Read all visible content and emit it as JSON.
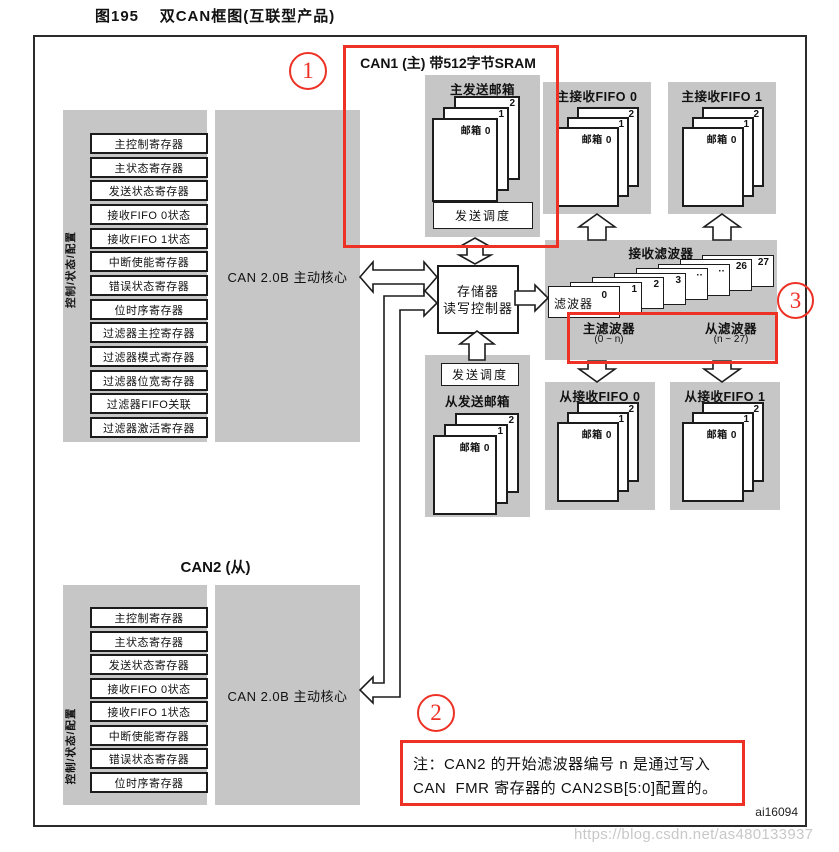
{
  "page": {
    "title": "图195    双CAN框图(互联型产品)",
    "figure_id": "ai16094",
    "watermark": "https://blog.csdn.net/as480133937"
  },
  "annotations": {
    "circle1": "1",
    "circle2": "2",
    "circle3": "3"
  },
  "can1": {
    "section_title": "CAN1 (主) 带512字节SRAM",
    "side_label": "控制/状态/配置",
    "core_label": "CAN 2.0B 主动核心",
    "registers": [
      "主控制寄存器",
      "主状态寄存器",
      "发送状态寄存器",
      "接收FIFO 0状态",
      "接收FIFO 1状态",
      "中断使能寄存器",
      "错误状态寄存器",
      "位时序寄存器",
      "过滤器主控寄存器",
      "过滤器模式寄存器",
      "过滤器位宽寄存器",
      "过滤器FIFO关联",
      "过滤器激活寄存器"
    ],
    "tx": {
      "title": "主发送邮箱",
      "mailbox_front": "邮箱 0",
      "page1": "1",
      "page2": "2",
      "scheduler": "发送调度"
    },
    "fifo0": {
      "title": "主接收FIFO 0",
      "mailbox_front": "邮箱 0",
      "page1": "1",
      "page2": "2"
    },
    "fifo1": {
      "title": "主接收FIFO 1",
      "mailbox_front": "邮箱 0",
      "page1": "1",
      "page2": "2"
    }
  },
  "memctrl": {
    "line1": "存储器",
    "line2": "读写控制器"
  },
  "filters": {
    "title": "接收滤波器",
    "front_name": "滤波器",
    "front_num": "0",
    "nums": [
      "1",
      "2",
      "3",
      "··",
      "··",
      "26",
      "27"
    ],
    "master_label": "主滤波器",
    "master_range": "(0 ~ n)",
    "slave_label": "从滤波器",
    "slave_range": "(n ~ 27)"
  },
  "slave_tx": {
    "scheduler": "发送调度",
    "title": "从发送邮箱",
    "mailbox_front": "邮箱 0",
    "page1": "1",
    "page2": "2"
  },
  "slave_fifo0": {
    "title": "从接收FIFO 0",
    "mailbox_front": "邮箱 0",
    "page1": "1",
    "page2": "2"
  },
  "slave_fifo1": {
    "title": "从接收FIFO 1",
    "mailbox_front": "邮箱 0",
    "page1": "1",
    "page2": "2"
  },
  "can2": {
    "section_title": "CAN2 (从)",
    "side_label": "控制/状态/配置",
    "core_label": "CAN 2.0B 主动核心",
    "registers": [
      "主控制寄存器",
      "主状态寄存器",
      "发送状态寄存器",
      "接收FIFO 0状态",
      "接收FIFO 1状态",
      "中断使能寄存器",
      "错误状态寄存器",
      "位时序寄存器"
    ]
  },
  "note": {
    "line1": "注：CAN2 的开始滤波器编号 n 是通过写入",
    "line2": "CAN  FMR 寄存器的 CAN2SB[5:0]配置的。"
  },
  "colors": {
    "panel_gray": "#c6c6c6",
    "highlight_red": "#ed3125",
    "watermark_gray": "#c8c8c8"
  }
}
